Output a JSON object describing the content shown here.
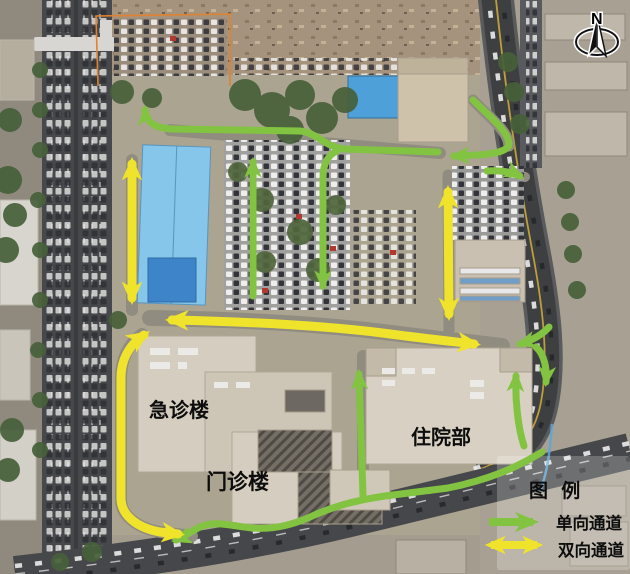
{
  "map": {
    "building_labels": [
      {
        "id": "emergency",
        "text": "急诊楼"
      },
      {
        "id": "outpatient",
        "text": "门诊楼"
      },
      {
        "id": "inpatient",
        "text": "住院部"
      }
    ],
    "compass": {
      "label": "N"
    },
    "legend": {
      "title": "图 例",
      "items": [
        {
          "label": "单向通道",
          "type": "one-way"
        },
        {
          "label": "双向通道",
          "type": "two-way"
        }
      ]
    },
    "colors": {
      "one_way_green": "#82c341",
      "two_way_yellow": "#efe32b"
    }
  }
}
